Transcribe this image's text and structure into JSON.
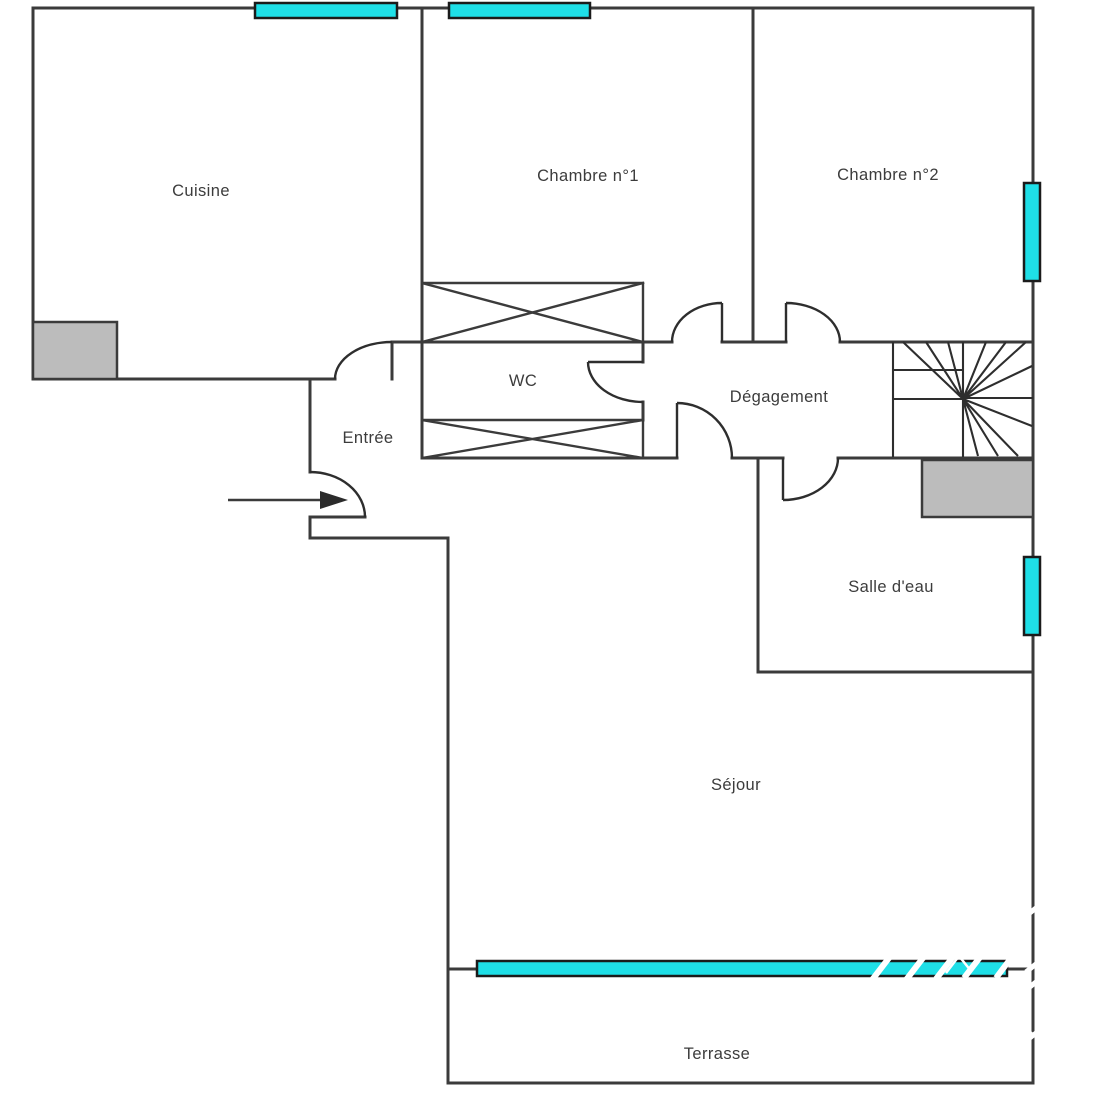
{
  "colors": {
    "window": "#1fdfe7",
    "fixture": "#bcbcbc",
    "wall": "#3b3b3b",
    "label": "#3c3c3c"
  },
  "rooms": {
    "cuisine": {
      "label": "Cuisine"
    },
    "chambre1": {
      "label": "Chambre n°1"
    },
    "chambre2": {
      "label": "Chambre n°2"
    },
    "wc": {
      "label": "WC"
    },
    "degagement": {
      "label": "Dégagement"
    },
    "entree": {
      "label": "Entrée"
    },
    "salle_eau": {
      "label": "Salle d'eau"
    },
    "sejour": {
      "label": "Séjour"
    },
    "terrasse": {
      "label": "Terrasse"
    }
  }
}
